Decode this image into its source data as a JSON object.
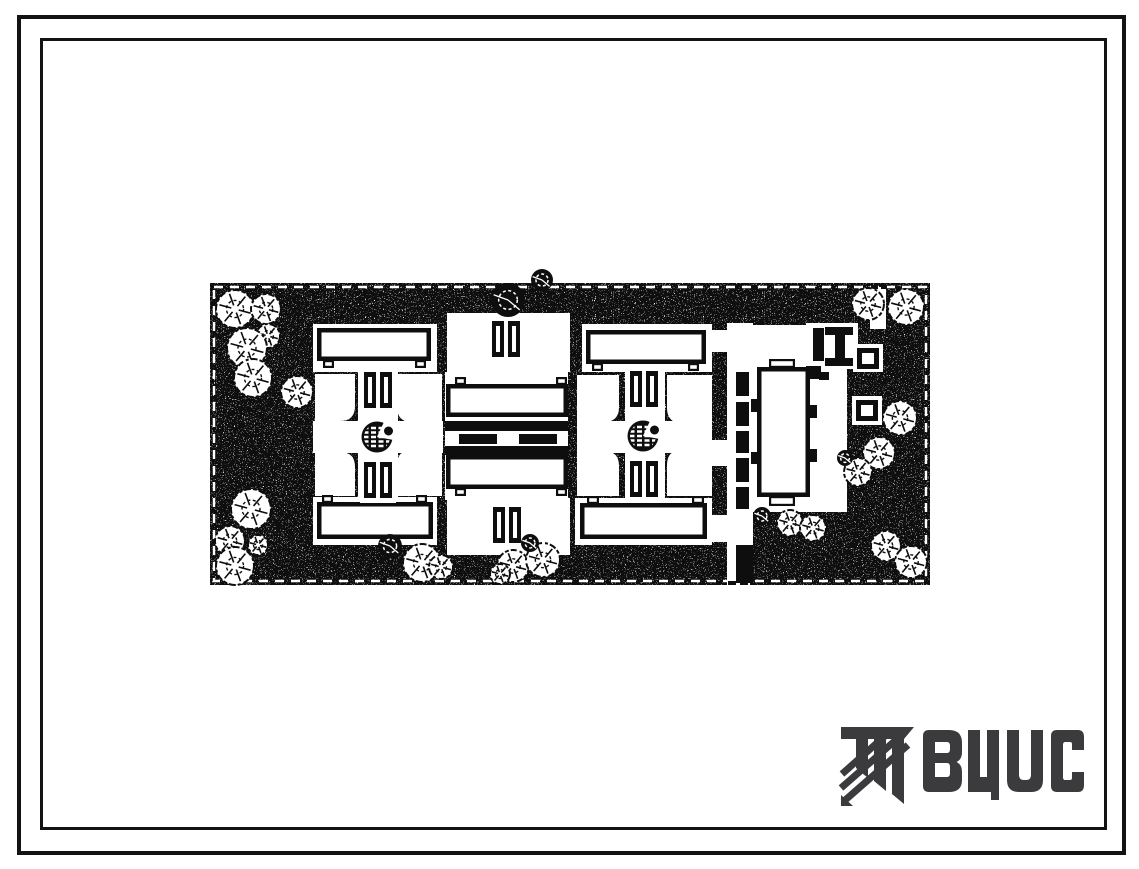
{
  "sheet": {
    "background": "#ffffff",
    "ink": "#111111",
    "paper": "#ffffff"
  },
  "frame": {
    "outer": {
      "x": 17,
      "y": 15,
      "w": 1109,
      "h": 840,
      "stroke": 4
    },
    "inner": {
      "x": 40,
      "y": 38,
      "w": 1067,
      "h": 792,
      "stroke": 3
    }
  },
  "logo": {
    "text": "ВЦИС",
    "color": "#3b3b3d"
  },
  "site_plan": {
    "x": 210,
    "y": 283,
    "w": 720,
    "h": 302,
    "ink": "#0e0e0e",
    "paper": "#ffffff",
    "boundary_dash_inset": 4,
    "whites": [
      [
        313,
        324,
        124,
        48
      ],
      [
        447,
        313,
        123,
        59
      ],
      [
        582,
        324,
        130,
        48
      ],
      [
        313,
        421,
        130,
        32
      ],
      [
        577,
        421,
        135,
        32
      ],
      [
        358,
        360,
        40,
        145
      ],
      [
        625,
        360,
        40,
        145
      ],
      [
        445,
        372,
        123,
        128
      ],
      [
        313,
        497,
        124,
        48
      ],
      [
        447,
        498,
        123,
        57
      ],
      [
        575,
        498,
        137,
        47
      ],
      [
        727,
        323,
        26,
        262
      ],
      [
        751,
        325,
        96,
        187
      ],
      [
        806,
        323,
        52,
        46
      ],
      [
        853,
        344,
        30,
        28
      ],
      [
        852,
        396,
        30,
        29
      ],
      [
        870,
        287,
        16,
        42
      ],
      [
        712,
        330,
        17,
        22
      ],
      [
        712,
        440,
        17,
        26
      ],
      [
        712,
        515,
        17,
        27
      ]
    ],
    "courtyards": [
      [
        315,
        374,
        40,
        47,
        "br"
      ],
      [
        397,
        374,
        45,
        48,
        "bl"
      ],
      [
        315,
        452,
        40,
        44,
        "tr"
      ],
      [
        397,
        450,
        45,
        46,
        "tl"
      ],
      [
        577,
        375,
        42,
        47,
        "br"
      ],
      [
        667,
        375,
        45,
        48,
        "bl"
      ],
      [
        577,
        451,
        42,
        45,
        "tr"
      ],
      [
        667,
        450,
        45,
        46,
        "tl"
      ]
    ],
    "buildings": [
      {
        "r": [
          317,
          328,
          114,
          33
        ],
        "n": [
          [
            323,
            360,
            11,
            8
          ],
          [
            415,
            360,
            11,
            8
          ]
        ]
      },
      {
        "r": [
          317,
          502,
          116,
          37
        ],
        "n": [
          [
            322,
            495,
            11,
            8
          ],
          [
            416,
            495,
            11,
            8
          ]
        ]
      },
      {
        "r": [
          586,
          330,
          120,
          34
        ],
        "n": [
          [
            592,
            363,
            11,
            8
          ],
          [
            688,
            363,
            11,
            8
          ]
        ]
      },
      {
        "r": [
          580,
          503,
          127,
          36
        ],
        "n": [
          [
            587,
            496,
            12,
            8
          ],
          [
            692,
            496,
            12,
            8
          ]
        ]
      },
      {
        "r": [
          446,
          384,
          122,
          33
        ],
        "n": [
          [
            455,
            377,
            11,
            8
          ],
          [
            556,
            377,
            11,
            8
          ]
        ]
      },
      {
        "r": [
          446,
          455,
          122,
          34
        ],
        "n": [
          [
            455,
            488,
            11,
            8
          ],
          [
            556,
            488,
            11,
            8
          ]
        ]
      },
      {
        "r": [
          757,
          367,
          53,
          130
        ],
        "n": [
          [
            769,
            359,
            26,
            9
          ],
          [
            769,
            496,
            26,
            10
          ]
        ]
      }
    ],
    "pair_blocks": [
      [
        360,
        367
      ],
      [
        360,
        457
      ],
      [
        488,
        316
      ],
      [
        489,
        502
      ],
      [
        626,
        366
      ],
      [
        626,
        456
      ]
    ],
    "fountains": [
      [
        377,
        437
      ],
      [
        643,
        436
      ]
    ],
    "ring_squares": [
      [
        853,
        344
      ],
      [
        852,
        396
      ]
    ],
    "blacks": [
      [
        445,
        421,
        123,
        10
      ],
      [
        445,
        446,
        123,
        9
      ],
      [
        459,
        434,
        38,
        10
      ],
      [
        519,
        434,
        38,
        10
      ],
      [
        736,
        372,
        13,
        24
      ],
      [
        736,
        402,
        13,
        24
      ],
      [
        736,
        431,
        13,
        22
      ],
      [
        736,
        458,
        13,
        24
      ],
      [
        736,
        487,
        13,
        22
      ],
      [
        736,
        545,
        17,
        38
      ],
      [
        813,
        328,
        11,
        33
      ],
      [
        825,
        327,
        28,
        8
      ],
      [
        835,
        335,
        10,
        25
      ],
      [
        825,
        358,
        28,
        8
      ],
      [
        806,
        366,
        15,
        13
      ],
      [
        819,
        372,
        10,
        8
      ],
      [
        800,
        371,
        9,
        9
      ],
      [
        751,
        399,
        7,
        13
      ],
      [
        751,
        452,
        7,
        12
      ],
      [
        810,
        405,
        7,
        13
      ],
      [
        810,
        449,
        7,
        13
      ],
      [
        728,
        581,
        8,
        4
      ],
      [
        740,
        581,
        8,
        4
      ],
      [
        750,
        581,
        3,
        4
      ],
      [
        871,
        285,
        7,
        4
      ],
      [
        881,
        285,
        6,
        4
      ]
    ],
    "trees": [
      [
        235,
        309,
        19,
        1
      ],
      [
        266,
        309,
        15,
        1
      ],
      [
        268,
        336,
        12,
        1
      ],
      [
        247,
        348,
        20,
        1
      ],
      [
        253,
        378,
        19,
        1
      ],
      [
        297,
        392,
        16,
        1
      ],
      [
        251,
        509,
        20,
        1
      ],
      [
        230,
        541,
        15,
        1
      ],
      [
        258,
        545,
        10,
        1
      ],
      [
        235,
        566,
        19,
        1
      ],
      [
        390,
        546,
        12,
        2
      ],
      [
        422,
        563,
        19,
        1
      ],
      [
        441,
        567,
        12,
        1
      ],
      [
        513,
        566,
        16,
        1
      ],
      [
        543,
        560,
        17,
        1
      ],
      [
        500,
        574,
        10,
        1
      ],
      [
        530,
        543,
        9,
        2
      ],
      [
        508,
        300,
        17,
        2
      ],
      [
        542,
        280,
        11,
        2
      ],
      [
        868,
        304,
        16,
        1
      ],
      [
        906,
        307,
        18,
        1
      ],
      [
        900,
        418,
        17,
        1
      ],
      [
        879,
        453,
        16,
        1
      ],
      [
        858,
        472,
        14,
        1
      ],
      [
        845,
        458,
        8,
        2
      ],
      [
        886,
        546,
        15,
        1
      ],
      [
        911,
        562,
        16,
        1
      ],
      [
        790,
        523,
        13,
        1
      ],
      [
        813,
        528,
        13,
        1
      ],
      [
        762,
        516,
        9,
        2
      ]
    ]
  }
}
